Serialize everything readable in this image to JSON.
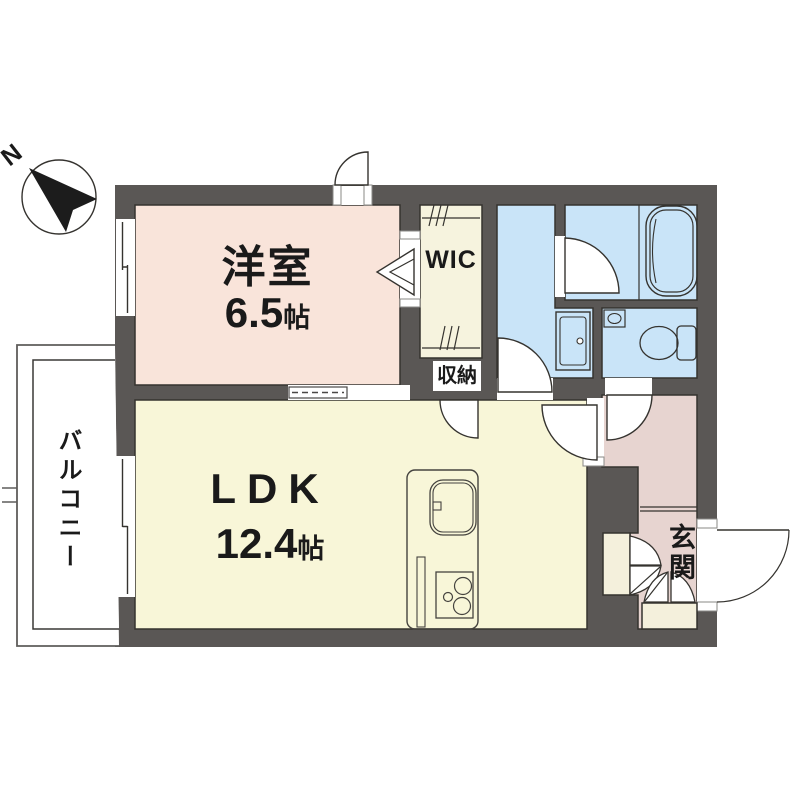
{
  "title": "apartment-floor-plan",
  "compass": {
    "north_label": "N"
  },
  "rooms": {
    "yoshitsu": {
      "label": "洋室",
      "size_value": "6.5",
      "size_unit": "帖"
    },
    "ldk": {
      "label": "LDK",
      "size_value": "12.4",
      "size_unit": "帖"
    },
    "wic": {
      "label": "WIC"
    },
    "shuno": {
      "label": "収納"
    },
    "genkan": {
      "label": "玄関"
    },
    "balcony": {
      "label": "バルコニー"
    }
  },
  "colors": {
    "wall": "#5a5755",
    "yoshitsu_floor": "#f9e4da",
    "wic_floor": "#f6f3de",
    "ldk_floor": "#f8f6d8",
    "wet_area_floor": "#c9e4f8",
    "hall_floor": "#e7d4d0",
    "closet_fill": "#f4f0dc",
    "outline": "#35332f",
    "background": "#ffffff"
  }
}
